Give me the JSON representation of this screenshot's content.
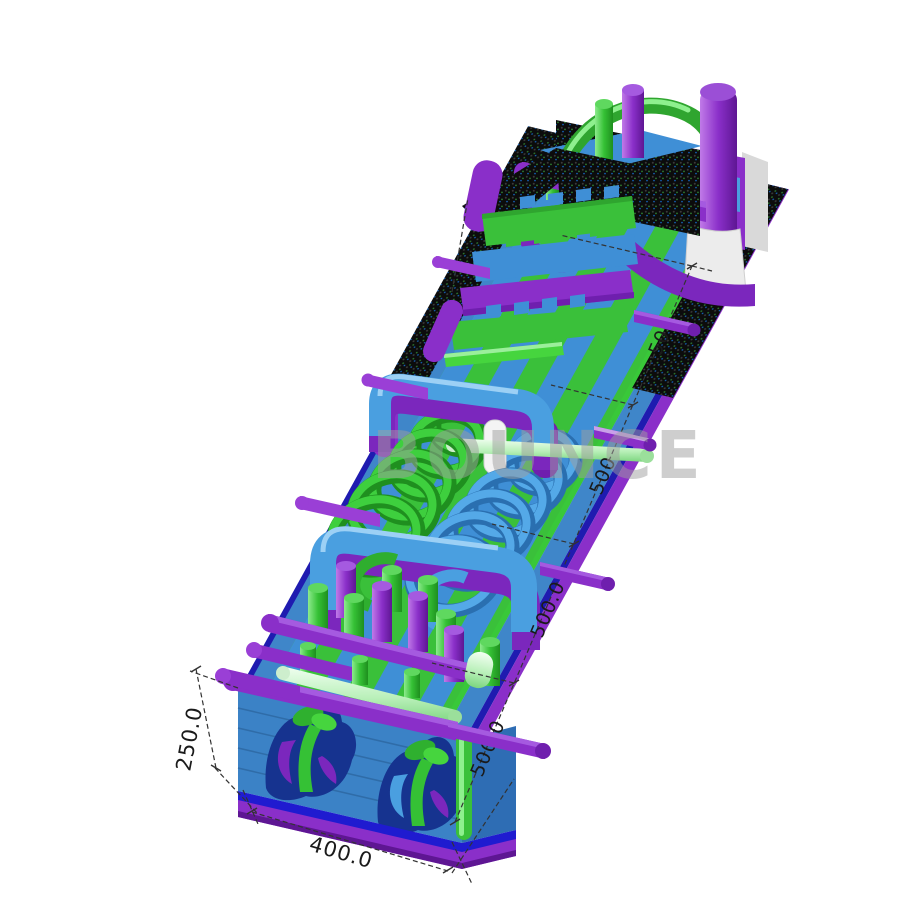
{
  "alt_text": "3D render of an inflatable obstacle course with dimension lines",
  "watermark": {
    "text": "BOUNCE"
  },
  "dimensions": {
    "bottom_width": {
      "label": "400.0"
    },
    "left_height": {
      "label": "250.0"
    },
    "right_segments": {
      "labels": [
        "500.0",
        "500.0",
        "500",
        "500"
      ]
    }
  },
  "colors": {
    "green": "#3ac03a",
    "blue": "#3f86c9",
    "purple": "#8a2fc9",
    "navy": "#1f1bd0",
    "mesh_black": "#0c0c0c",
    "light_tube": "#d8f7d8",
    "watermark_gray": "#9f9f9f",
    "dimension_line": "#333333"
  }
}
